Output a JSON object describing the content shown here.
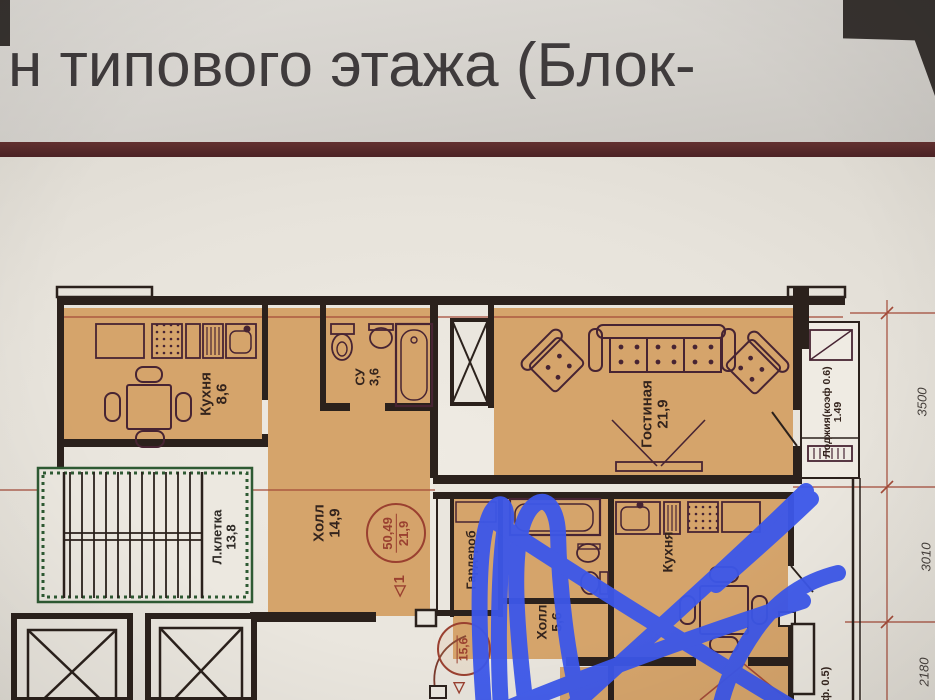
{
  "title": "н типового этажа (Блок-",
  "colors": {
    "header_bar_maroon": "#54282a",
    "apartment_fill_orange": "#d5a46b",
    "wall_dark": "#2b211c",
    "stair_green": "#2e5a33",
    "stamp_red": "#9a4030",
    "axis_red": "#a34a38",
    "scribble_blue": "#3c57ea",
    "paper": "#e7e3db"
  },
  "plan": {
    "rooms": {
      "kitchen1": {
        "name": "Кухня",
        "area": "8,6"
      },
      "wc1": {
        "name": "СУ",
        "area": "3,6"
      },
      "living1": {
        "name": "Гостиная",
        "area": "21,9"
      },
      "hall1": {
        "name": "Холл",
        "area": "14,9"
      },
      "stairwell": {
        "name": "Л.клетка",
        "area": "13,8"
      },
      "wardrobe2": {
        "name": "Гардероб",
        "area": ""
      },
      "loggia1": {
        "name": "Лоджия(коэф 0.6)",
        "area": "1.49"
      },
      "kitchen2": {
        "name": "Кухня",
        "area": ""
      },
      "hall2": {
        "name": "Холл",
        "area": "5,6"
      },
      "loggia2": {
        "name": "ф. 0.5)",
        "area": ""
      }
    },
    "stamps": {
      "apt1": {
        "total": "50,49",
        "living": "21,9",
        "unit": "1",
        "marker": "◁"
      },
      "apt2": {
        "total": "",
        "living": "15,6",
        "unit": "",
        "marker": "◁"
      }
    },
    "dims": {
      "d1": "3500",
      "d2": "3010",
      "d3": "2180"
    }
  }
}
